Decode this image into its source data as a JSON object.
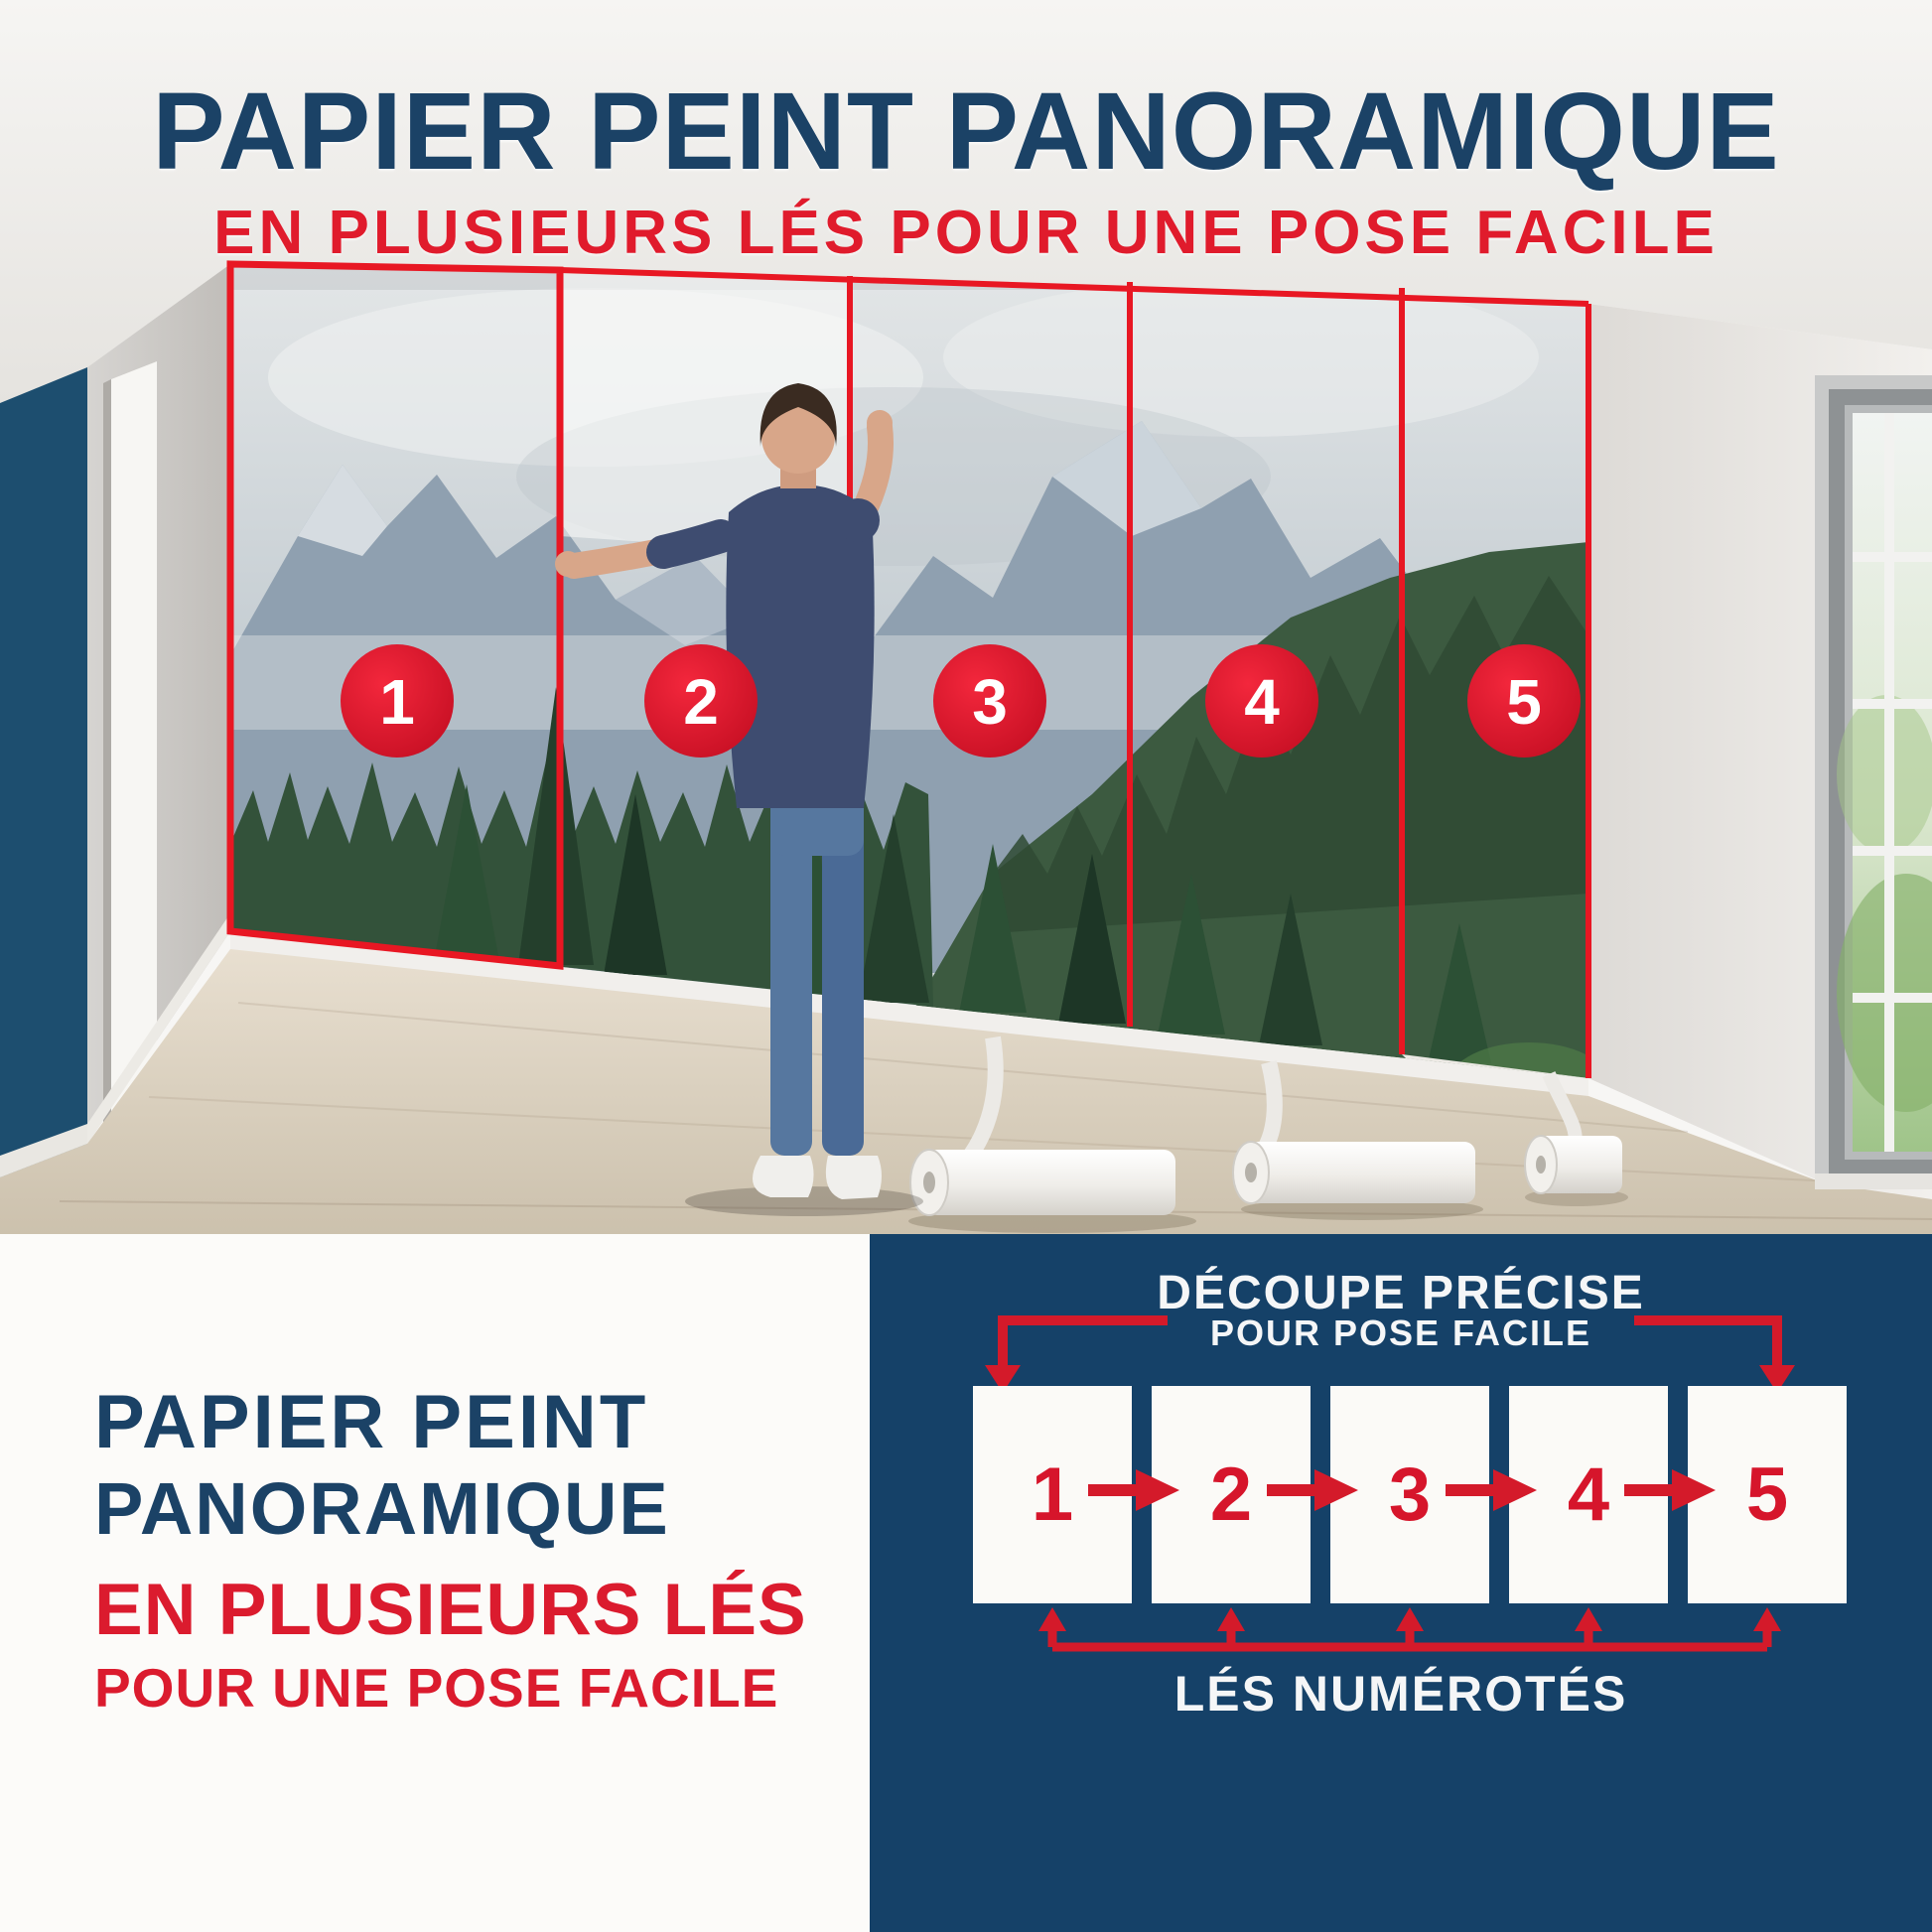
{
  "header": {
    "title": "PAPIER PEINT PANORAMIQUE",
    "subtitle": "EN PLUSIEURS LÉS POUR UNE POSE FACILE"
  },
  "photo": {
    "description": "man installing panoramic mountain-forest wallpaper in five numbered strips",
    "panel_numbers": [
      "1",
      "2",
      "3",
      "4",
      "5"
    ]
  },
  "left_panel": {
    "title_line1": "PAPIER PEINT",
    "title_line2": "PANORAMIQUE",
    "subtitle_line1": "EN PLUSIEURS LÉS",
    "subtitle_line2": "POUR UNE POSE FACILE"
  },
  "diagram": {
    "title_line1": "DÉCOUPE PRÉCISE",
    "title_line2": "POUR POSE FACILE",
    "strip_numbers": [
      "1",
      "2",
      "3",
      "4",
      "5"
    ],
    "caption": "LÉS NUMÉROTÉS"
  },
  "colors": {
    "navy_text": "#1b4266",
    "navy_panel": "#154168",
    "red_text": "#e01b2c",
    "red_marker": "#d9142b",
    "white": "#ffffff",
    "wood_floor": "#d8cdbb",
    "accent_wall_blue": "#1d4e6f"
  }
}
